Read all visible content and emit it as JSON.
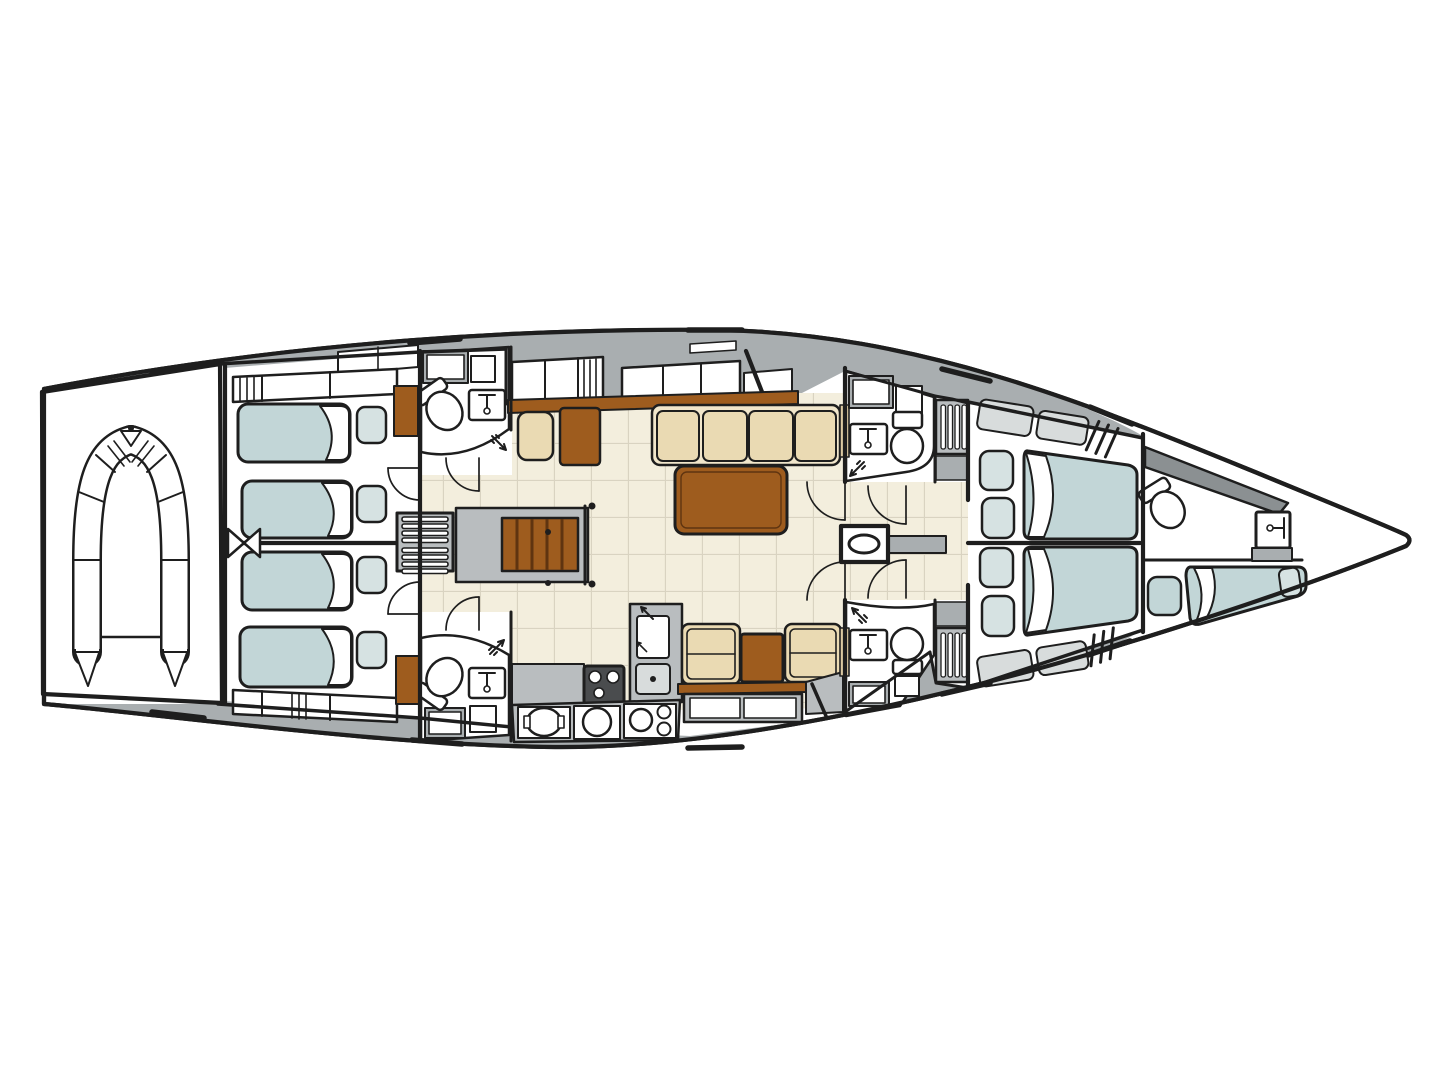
{
  "meta": {
    "title": "Sailing yacht interior deck plan (top view, bow to the right)",
    "image_type": "boat floor plan drawing",
    "contains_text": false
  },
  "palette": {
    "background": "#ffffff",
    "outline": "#1e1e1e",
    "deck_gray": "#a9aeb0",
    "dark_gray": "#8b9092",
    "panel_gray": "#b9bdbf",
    "shelf_gray": "#d8dcdc",
    "room_white": "#ffffff",
    "floor_cream": "#f3eedd",
    "floor_line": "#d9d3c1",
    "berth_blue": "#c2d6d7",
    "pillow_blue": "#d6e2e2",
    "cushion_cream": "#eadab3",
    "cushion_base": "#f1e6cb",
    "wood": "#9e5c1e",
    "wood_dark": "#5f3410",
    "stove_dark": "#4a4c4e",
    "trim_tan": "#dcc9a2"
  },
  "legend": {
    "rooms": [
      {
        "id": "tender-garage",
        "label": "Transom garage with inflatable dinghy"
      },
      {
        "id": "aft-cabin-port",
        "label": "Aft twin cabin, 2 single berths with pillows"
      },
      {
        "id": "aft-cabin-starboard",
        "label": "Aft twin cabin, 2 single berths with pillows"
      },
      {
        "id": "aft-head-port",
        "label": "Aft head: WC, washbasin, shower"
      },
      {
        "id": "aft-head-starboard",
        "label": "Aft head: WC, washbasin, shower"
      },
      {
        "id": "engine-compartment",
        "label": "Engine compartment with louvered hatches"
      },
      {
        "id": "companionway",
        "label": "Companionway wooden steps"
      },
      {
        "id": "salon",
        "label": "Salon: navigation seat and desk, 4-cushion sofa, dining table"
      },
      {
        "id": "galley",
        "label": "Galley: stove, sinks, lockers and facing dinette seats"
      },
      {
        "id": "mast-post",
        "label": "Mast post on centerline"
      },
      {
        "id": "fwd-head-port",
        "label": "Forward head: WC, washbasin, shower"
      },
      {
        "id": "fwd-head-starboard",
        "label": "Forward head: WC, washbasin, shower"
      },
      {
        "id": "owner-cabin",
        "label": "Forward cabin, 2 double berths with pillows"
      },
      {
        "id": "bow-cabin",
        "label": "Bow crew cabin: WC, washbasin, single berth and seat"
      }
    ],
    "fixture_counts": {
      "single_berths": 5,
      "double_berths": 2,
      "toilets": 5,
      "washbasins": 5,
      "showers": 4,
      "dining_tables": 2
    }
  }
}
